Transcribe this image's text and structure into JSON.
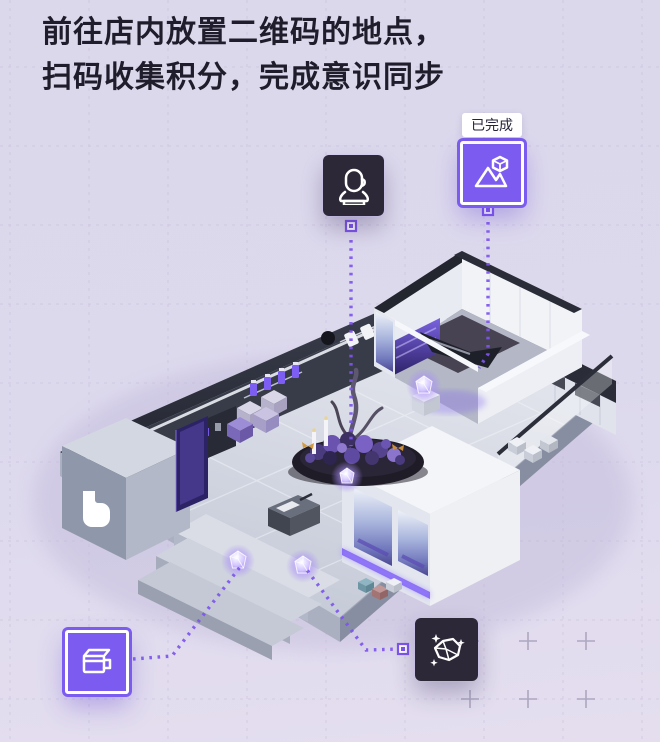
{
  "header": {
    "line1": "前往店内放置二维码的地点，",
    "line2": "扫码收集积分，完成意识同步"
  },
  "map": {
    "completed_tag": "已完成",
    "points": [
      {
        "id": "voice-booth",
        "icon": "microphone-icon",
        "badge_style": "dark",
        "status": ""
      },
      {
        "id": "photo-spot",
        "icon": "mountain-gem-icon",
        "badge_style": "purple",
        "status": "已完成"
      },
      {
        "id": "coffee-bar",
        "icon": "coffee-mug-icon",
        "badge_style": "purple",
        "status": ""
      },
      {
        "id": "gem-display",
        "icon": "gem-sparkle-icon",
        "badge_style": "dark",
        "status": ""
      }
    ]
  },
  "colors": {
    "accent_purple": "#7c5bf1",
    "dark_badge": "#2d2837",
    "connector": "#7d55ef",
    "background": "#dcd8ec",
    "tag_background": "#ffffff"
  }
}
